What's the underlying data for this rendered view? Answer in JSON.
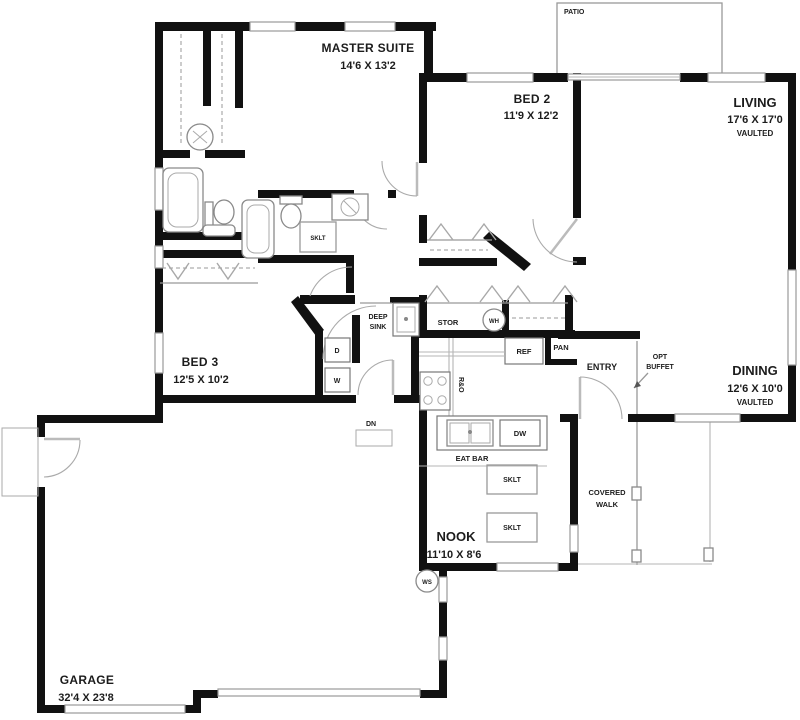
{
  "plan": {
    "patio": {
      "label": "PATIO"
    },
    "master": {
      "name": "MASTER SUITE",
      "dims": "14'6 X 13'2"
    },
    "bed2": {
      "name": "BED 2",
      "dims": "11'9 X 12'2"
    },
    "living": {
      "name": "LIVING",
      "dims": "17'6 X 17'0",
      "note": "VAULTED"
    },
    "dining": {
      "name": "DINING",
      "dims": "12'6 X 10'0",
      "note": "VAULTED"
    },
    "bed3": {
      "name": "BED 3",
      "dims": "12'5 X 10'2"
    },
    "nook": {
      "name": "NOOK",
      "dims": "11'10 X 8'6"
    },
    "garage": {
      "name": "GARAGE",
      "dims": "32'4 X 23'8"
    },
    "entry": {
      "label": "ENTRY"
    },
    "covered_walk": {
      "line1": "COVERED",
      "line2": "WALK"
    },
    "opt_buffet": {
      "line1": "OPT",
      "line2": "BUFFET"
    },
    "kitchen": {
      "deep_sink_line1": "DEEP",
      "deep_sink_line2": "SINK",
      "stor": "STOR",
      "water_heater": "WH",
      "ref": "REF",
      "pantry": "PAN",
      "range": "R&O",
      "eat_bar": "EAT BAR",
      "dishwasher": "DW",
      "down": "DN",
      "water_softener": "WS",
      "dryer": "D",
      "washer": "W"
    },
    "skylight": "SKLT",
    "colors": {
      "wall": "#111111",
      "line": "#999999",
      "text": "#1c1c1c"
    }
  }
}
